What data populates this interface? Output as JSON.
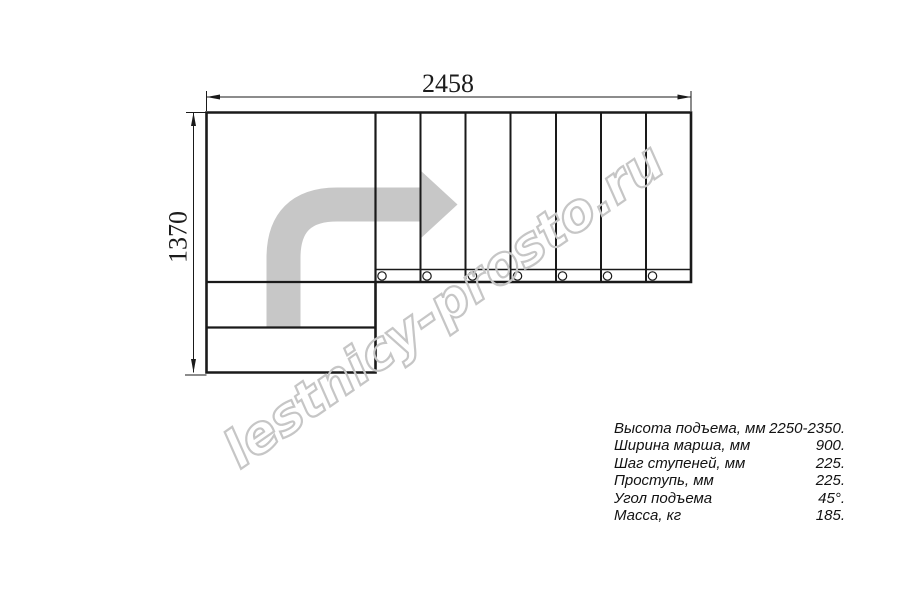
{
  "drawing": {
    "title": "L-shaped staircase plan view",
    "dim_width": "2458",
    "dim_height": "1370",
    "watermark": "lestnicy-prosto.ru",
    "upper_flight_treads": 7,
    "lower_flight_steps": 2,
    "bolt_circles": 7,
    "direction_arrow": "quarter-turn-right-arrow"
  },
  "colors": {
    "line": "#1a1a1a",
    "arrow_gray": "#c7c7c7",
    "watermark_gray": "#c6c6c6",
    "background": "#ffffff"
  },
  "specs": {
    "rows": [
      {
        "label": "Высота подъема, мм",
        "value": "2250-2350."
      },
      {
        "label": "Ширина марша, мм",
        "value": "900."
      },
      {
        "label": "Шаг ступеней, мм",
        "value": "225."
      },
      {
        "label": "Проступь, мм",
        "value": "225."
      },
      {
        "label": "Угол подъема",
        "value": "45°."
      },
      {
        "label": "Масса, кг",
        "value": "185."
      }
    ]
  }
}
